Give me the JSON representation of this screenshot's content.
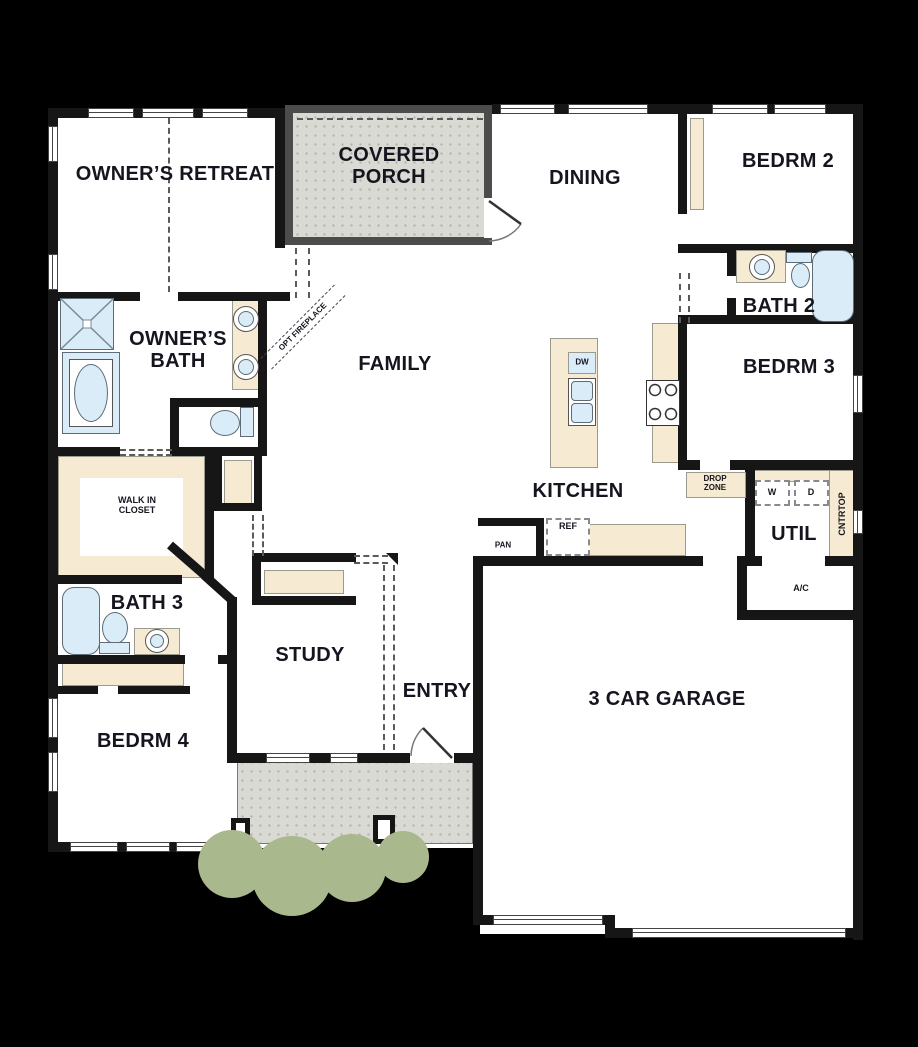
{
  "plan": {
    "title": "single-story floor plan",
    "rooms": {
      "owners_retreat": "OWNER’S RETREAT",
      "covered_porch_line1": "COVERED",
      "covered_porch_line2": "PORCH",
      "dining": "DINING",
      "bedrm2": "BEDRM 2",
      "bath2": "BATH 2",
      "bedrm3": "BEDRM 3",
      "family": "FAMILY",
      "owners_bath_line1": "OWNER’S",
      "owners_bath_line2": "BATH",
      "walk_in_closet_line1": "WALK IN",
      "walk_in_closet_line2": "CLOSET",
      "bath3": "BATH 3",
      "bedrm4": "BEDRM 4",
      "study": "STUDY",
      "entry": "ENTRY",
      "kitchen": "KITCHEN",
      "garage": "3 CAR GARAGE",
      "util": "UTIL",
      "ac": "A/C"
    },
    "annotations": {
      "opt_fireplace": "OPT FIREPLACE",
      "drop_zone_line1": "DROP",
      "drop_zone_line2": "ZONE",
      "cntrtop": "CNTRTOP",
      "dw": "DW",
      "ref": "REF",
      "pan": "PAN",
      "washer": "W",
      "dryer": "D"
    },
    "colors": {
      "wall": "#161616",
      "floor": "#ffffff",
      "background": "#000000",
      "counter": "#f7ead3",
      "fixture": "#d9ecf8",
      "porch": "#dadad4",
      "shrub": "#a9b88d",
      "label": "#15151f"
    }
  }
}
